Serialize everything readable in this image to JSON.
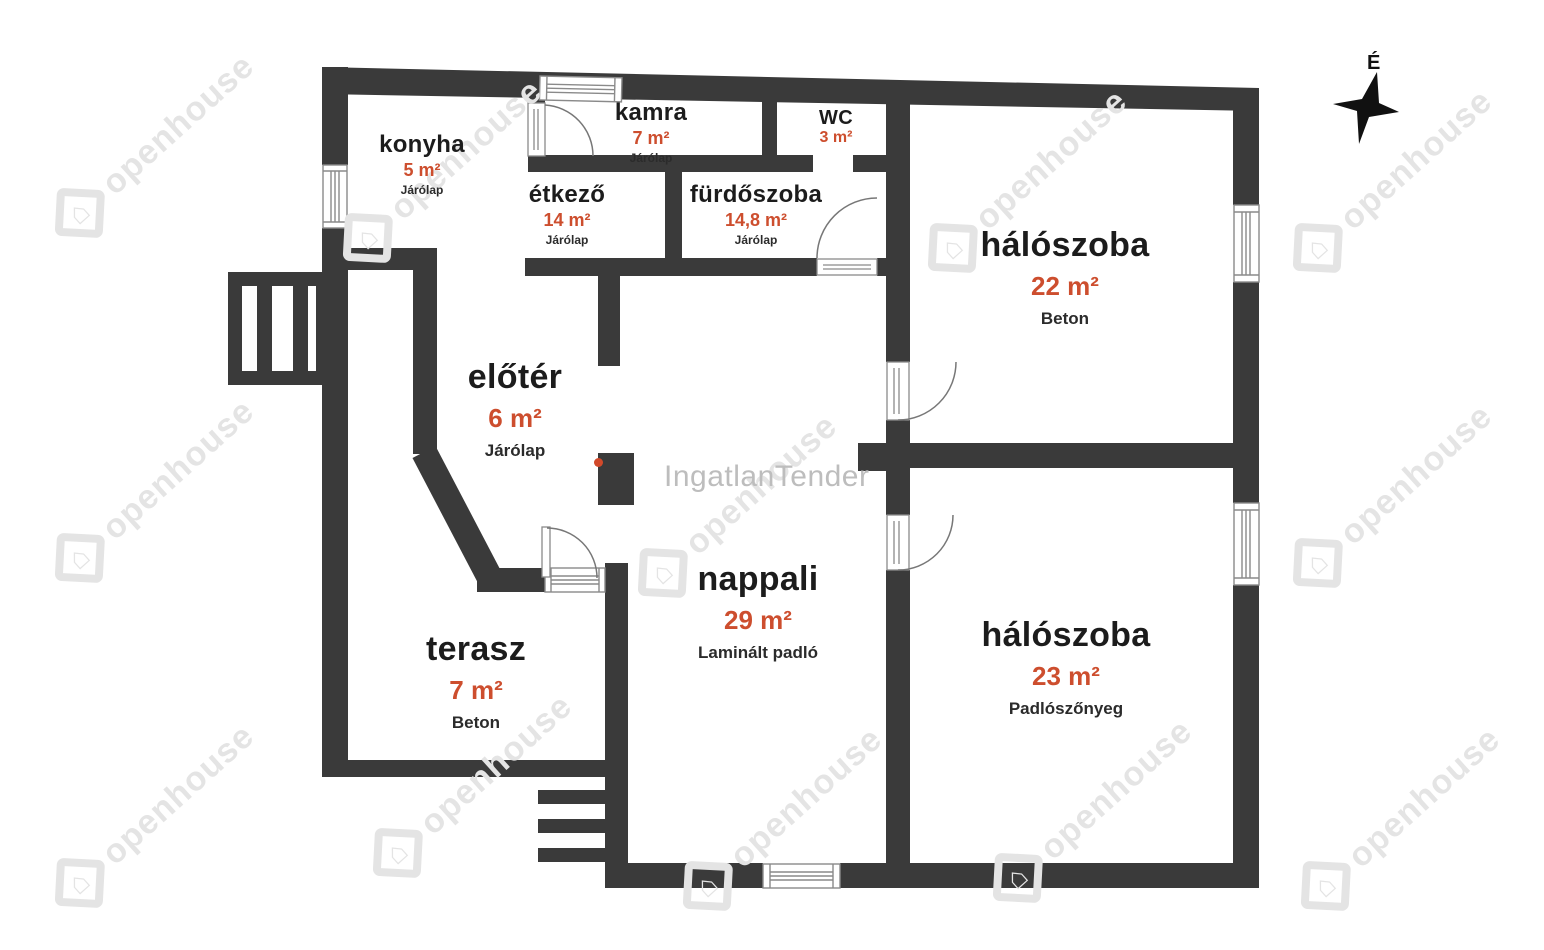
{
  "compass": {
    "north_label": "É"
  },
  "watermark": {
    "brand": "openhouse",
    "center_brand": "IngatlanTender"
  },
  "colors": {
    "wall": "#3a3a3a",
    "area_text": "#cd4e2e",
    "room_text": "#1c1c1c",
    "watermark_tile": "#e4e4e4",
    "watermark_center": "#bdbdbd"
  },
  "rooms": [
    {
      "id": "konyha",
      "name": "konyha",
      "area": "5 m²",
      "floor": "Járólap"
    },
    {
      "id": "kamra",
      "name": "kamra",
      "area": "7 m²",
      "floor": "Járólap"
    },
    {
      "id": "etkezo",
      "name": "étkező",
      "area": "14 m²",
      "floor": "Járólap"
    },
    {
      "id": "furdoszoba",
      "name": "fürdőszoba",
      "area": "14,8 m²",
      "floor": "Járólap"
    },
    {
      "id": "wc",
      "name": "WC",
      "area": "3 m²",
      "floor": ""
    },
    {
      "id": "haloszoba-1",
      "name": "hálószoba",
      "area": "22 m²",
      "floor": "Beton"
    },
    {
      "id": "eloter",
      "name": "előtér",
      "area": "6 m²",
      "floor": "Járólap"
    },
    {
      "id": "nappali",
      "name": "nappali",
      "area": "29 m²",
      "floor": "Laminált padló"
    },
    {
      "id": "terasz",
      "name": "terasz",
      "area": "7 m²",
      "floor": "Beton"
    },
    {
      "id": "haloszoba-2",
      "name": "hálószoba",
      "area": "23 m²",
      "floor": "Padlószőnyeg"
    }
  ]
}
